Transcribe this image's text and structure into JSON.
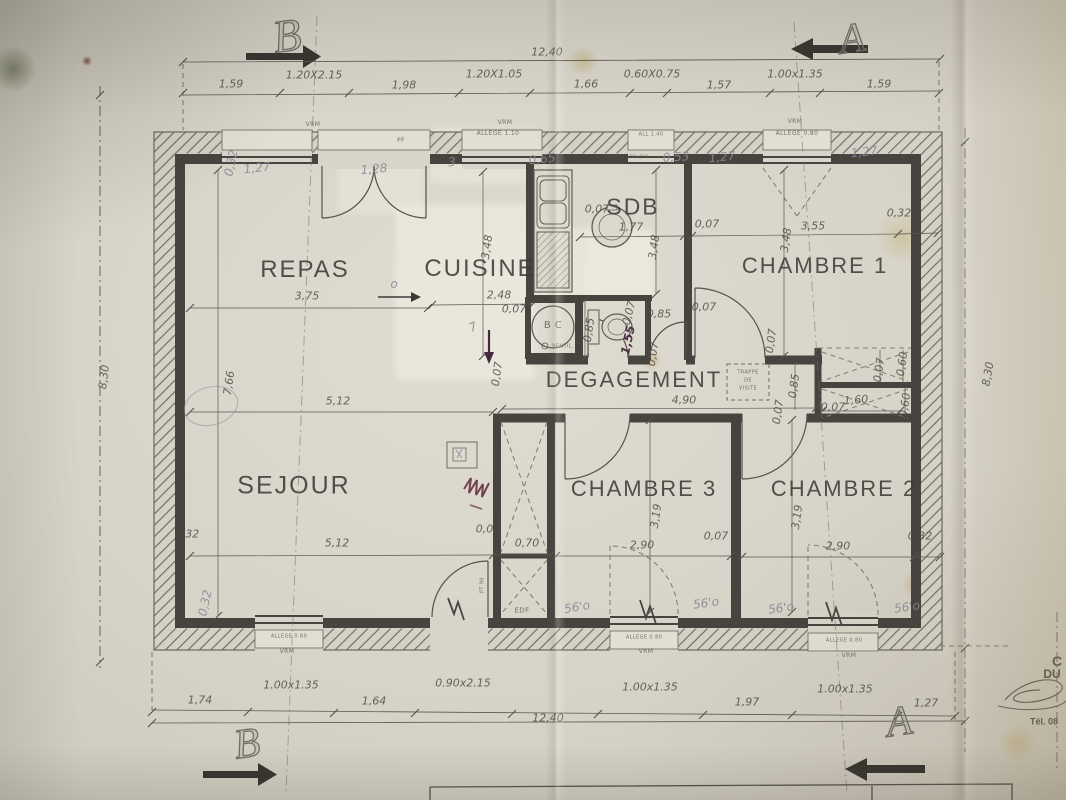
{
  "colors": {
    "paper": "#d8d4c9",
    "wall": "#45443f",
    "thin_line": "#5a5751",
    "pencil": "#8f8898",
    "ink_note": "#43283e",
    "red_scribble": "#5f2736"
  },
  "plan": {
    "section_markers": [
      {
        "name": "section-marker-b-top",
        "text": "B",
        "x": 287,
        "y": 36,
        "size": 46,
        "rot": -8
      },
      {
        "name": "section-marker-a-top",
        "text": "A",
        "x": 852,
        "y": 39,
        "size": 42,
        "rot": -8
      },
      {
        "name": "section-marker-b-bottom",
        "text": "B",
        "x": 247,
        "y": 744,
        "size": 42,
        "rot": -8
      },
      {
        "name": "section-marker-a-bottom",
        "text": "A",
        "x": 899,
        "y": 722,
        "size": 42,
        "rot": -8
      }
    ],
    "room_labels": [
      {
        "name": "room-label-repas",
        "text": "REPAS",
        "x": 305,
        "y": 270,
        "size": 24
      },
      {
        "name": "room-label-cuisine",
        "text": "CUISINE",
        "x": 480,
        "y": 269,
        "size": 24
      },
      {
        "name": "room-label-sdb",
        "text": "SDB",
        "x": 633,
        "y": 207,
        "size": 23
      },
      {
        "name": "room-label-chambre-1",
        "text": "CHAMBRE 1",
        "x": 815,
        "y": 266,
        "size": 22
      },
      {
        "name": "room-label-degagement",
        "text": "DEGAGEMENT",
        "x": 634,
        "y": 380,
        "size": 22
      },
      {
        "name": "room-label-sejour",
        "text": "SEJOUR",
        "x": 294,
        "y": 486,
        "size": 25
      },
      {
        "name": "room-label-chambre-3",
        "text": "CHAMBRE 3",
        "x": 644,
        "y": 489,
        "size": 22
      },
      {
        "name": "room-label-chambre-2",
        "text": "CHAMBRE 2",
        "x": 844,
        "y": 489,
        "size": 22
      }
    ],
    "dim_labels": [
      {
        "text": "1,59",
        "x": 231,
        "y": 84
      },
      {
        "text": "1.20X2.15",
        "x": 314,
        "y": 75
      },
      {
        "text": "1,98",
        "x": 404,
        "y": 85
      },
      {
        "text": "1.20X1.05",
        "x": 494,
        "y": 74
      },
      {
        "text": "1,66",
        "x": 586,
        "y": 84
      },
      {
        "text": "0.60X0.75",
        "x": 652,
        "y": 74
      },
      {
        "text": "1,57",
        "x": 719,
        "y": 85
      },
      {
        "text": "1.00x1.35",
        "x": 795,
        "y": 74
      },
      {
        "text": "1,59",
        "x": 879,
        "y": 84
      },
      {
        "text": "12,40",
        "x": 547,
        "y": 52
      },
      {
        "text": "1,74",
        "x": 200,
        "y": 700
      },
      {
        "text": "1.00x1.35",
        "x": 291,
        "y": 685
      },
      {
        "text": "1,64",
        "x": 374,
        "y": 701
      },
      {
        "text": "0.90x2.15",
        "x": 463,
        "y": 683
      },
      {
        "text": "1.00x1.35",
        "x": 650,
        "y": 687
      },
      {
        "text": "1,97",
        "x": 747,
        "y": 702
      },
      {
        "text": "1.00x1.35",
        "x": 845,
        "y": 689
      },
      {
        "text": "1,27",
        "x": 926,
        "y": 703
      },
      {
        "text": "12,40",
        "x": 548,
        "y": 718
      },
      {
        "text": "8,30",
        "x": 104,
        "y": 377,
        "rot": -83
      },
      {
        "text": "7,66",
        "x": 229,
        "y": 383,
        "rot": -82
      },
      {
        "text": "8,30",
        "x": 988,
        "y": 374,
        "rot": -80
      },
      {
        "text": "3,75",
        "x": 307,
        "y": 296
      },
      {
        "text": "2,48",
        "x": 499,
        "y": 295
      },
      {
        "text": "0,07",
        "x": 514,
        "y": 309
      },
      {
        "text": "3,48",
        "x": 487,
        "y": 247,
        "rot": -82
      },
      {
        "text": "0,07",
        "x": 597,
        "y": 209
      },
      {
        "text": "1,77",
        "x": 631,
        "y": 227
      },
      {
        "text": "3,48",
        "x": 654,
        "y": 247,
        "rot": -82
      },
      {
        "text": "0,07",
        "x": 707,
        "y": 224
      },
      {
        "text": "3,55",
        "x": 813,
        "y": 226
      },
      {
        "text": "3,48",
        "x": 786,
        "y": 240,
        "rot": -82
      },
      {
        "text": "0,32",
        "x": 899,
        "y": 213
      },
      {
        "text": "0,07",
        "x": 704,
        "y": 307
      },
      {
        "text": "0,85",
        "x": 659,
        "y": 314
      },
      {
        "text": "0,07",
        "x": 629,
        "y": 313,
        "rot": -75
      },
      {
        "text": "0,85",
        "x": 589,
        "y": 330,
        "rot": -82
      },
      {
        "text": "0,07",
        "x": 653,
        "y": 354,
        "rot": -82
      },
      {
        "text": "0,07",
        "x": 771,
        "y": 341,
        "rot": -82
      },
      {
        "text": "0,85",
        "x": 794,
        "y": 386,
        "rot": -82
      },
      {
        "text": "0,07",
        "x": 778,
        "y": 412,
        "rot": -82
      },
      {
        "text": "4,90",
        "x": 684,
        "y": 400
      },
      {
        "text": "0,07",
        "x": 879,
        "y": 370,
        "rot": -82
      },
      {
        "text": "0,60",
        "x": 902,
        "y": 364,
        "rot": -82
      },
      {
        "text": "1,60",
        "x": 856,
        "y": 400,
        "rot": -4
      },
      {
        "text": "0,07",
        "x": 833,
        "y": 407
      },
      {
        "text": "0,60",
        "x": 905,
        "y": 405,
        "rot": -82
      },
      {
        "text": "5,12",
        "x": 338,
        "y": 401
      },
      {
        "text": "0,07",
        "x": 497,
        "y": 374,
        "rot": -82
      },
      {
        "text": "0,32",
        "x": 187,
        "y": 534
      },
      {
        "text": "5,12",
        "x": 337,
        "y": 543
      },
      {
        "text": "0,07",
        "x": 488,
        "y": 529
      },
      {
        "text": "0,70",
        "x": 527,
        "y": 543
      },
      {
        "text": "3,19",
        "x": 656,
        "y": 516,
        "rot": -82
      },
      {
        "text": "2,90",
        "x": 642,
        "y": 545
      },
      {
        "text": "0,07",
        "x": 716,
        "y": 536
      },
      {
        "text": "3,19",
        "x": 797,
        "y": 517,
        "rot": -82
      },
      {
        "text": "2,90",
        "x": 838,
        "y": 546
      },
      {
        "text": "0,32",
        "x": 920,
        "y": 536
      }
    ],
    "wall_labels": [
      {
        "text": "VRM",
        "x": 313,
        "y": 125,
        "size": 6
      },
      {
        "text": "PF",
        "x": 401,
        "y": 141,
        "size": 6
      },
      {
        "text": "VRM",
        "x": 505,
        "y": 123,
        "size": 6
      },
      {
        "text": "ALLEGE 1.10",
        "x": 498,
        "y": 134,
        "size": 6
      },
      {
        "text": "ALL 1.40",
        "x": 651,
        "y": 135,
        "size": 5
      },
      {
        "text": "VRM",
        "x": 795,
        "y": 122,
        "size": 6
      },
      {
        "text": "ALLEGE 0.80",
        "x": 797,
        "y": 134,
        "size": 6
      },
      {
        "text": "ALLEGE 0.80",
        "x": 289,
        "y": 637,
        "size": 5
      },
      {
        "text": "VRM",
        "x": 287,
        "y": 652,
        "size": 6
      },
      {
        "text": "EDF",
        "x": 522,
        "y": 611,
        "size": 7
      },
      {
        "text": "ALLEGE 0.80",
        "x": 644,
        "y": 638,
        "size": 5
      },
      {
        "text": "VRM",
        "x": 646,
        "y": 652,
        "size": 6
      },
      {
        "text": "ALLEGE 0.80",
        "x": 844,
        "y": 641,
        "size": 5
      },
      {
        "text": "VRM",
        "x": 849,
        "y": 656,
        "size": 6
      },
      {
        "text": "VENTIL.",
        "x": 563,
        "y": 347,
        "size": 5
      },
      {
        "text": "B  C",
        "x": 553,
        "y": 326,
        "size": 10
      },
      {
        "text": "TRAPPE",
        "x": 748,
        "y": 373,
        "size": 5
      },
      {
        "text": "DE",
        "x": 748,
        "y": 381,
        "size": 5
      },
      {
        "text": "VISITE",
        "x": 748,
        "y": 389,
        "size": 5
      },
      {
        "text": "PT 90",
        "x": 483,
        "y": 585,
        "size": 5,
        "rot": -90
      },
      {
        "text": "VR TOILETTE APPLIQUE",
        "x": 622,
        "y": 157,
        "size": 4
      }
    ],
    "handwritten": [
      {
        "text": "0,32",
        "x": 231,
        "y": 163,
        "rot": -78
      },
      {
        "text": "1,27",
        "x": 257,
        "y": 168,
        "rot": -6
      },
      {
        "text": "1,28",
        "x": 374,
        "y": 169,
        "rot": -5
      },
      {
        "text": "3",
        "x": 452,
        "y": 162,
        "rot": -5
      },
      {
        "text": "0,65",
        "x": 542,
        "y": 159,
        "rot": -6
      },
      {
        "text": "0,53",
        "x": 676,
        "y": 157,
        "rot": -4
      },
      {
        "text": "1,27",
        "x": 722,
        "y": 157,
        "rot": -6
      },
      {
        "text": "1,27",
        "x": 864,
        "y": 152,
        "rot": -6
      },
      {
        "text": "0,32",
        "x": 205,
        "y": 603,
        "rot": -78
      },
      {
        "text": "56'o",
        "x": 577,
        "y": 607,
        "rot": -10
      },
      {
        "text": "56'o",
        "x": 706,
        "y": 603,
        "rot": -8
      },
      {
        "text": "56'o",
        "x": 781,
        "y": 608,
        "rot": -8
      },
      {
        "text": "56'o",
        "x": 907,
        "y": 607,
        "rot": -8
      },
      {
        "text": "7",
        "x": 473,
        "y": 327,
        "rot": -25
      },
      {
        "text": "o",
        "x": 394,
        "y": 284
      },
      {
        "text": "1,55",
        "x": 628,
        "y": 340,
        "rot": -78,
        "cls": "ink"
      }
    ],
    "corner_text": [
      {
        "text": "C",
        "x": 1057,
        "y": 661,
        "size": 14
      },
      {
        "text": "DU",
        "x": 1052,
        "y": 674,
        "size": 12
      },
      {
        "text": "Tél. 08",
        "x": 1044,
        "y": 722,
        "size": 9
      }
    ]
  }
}
